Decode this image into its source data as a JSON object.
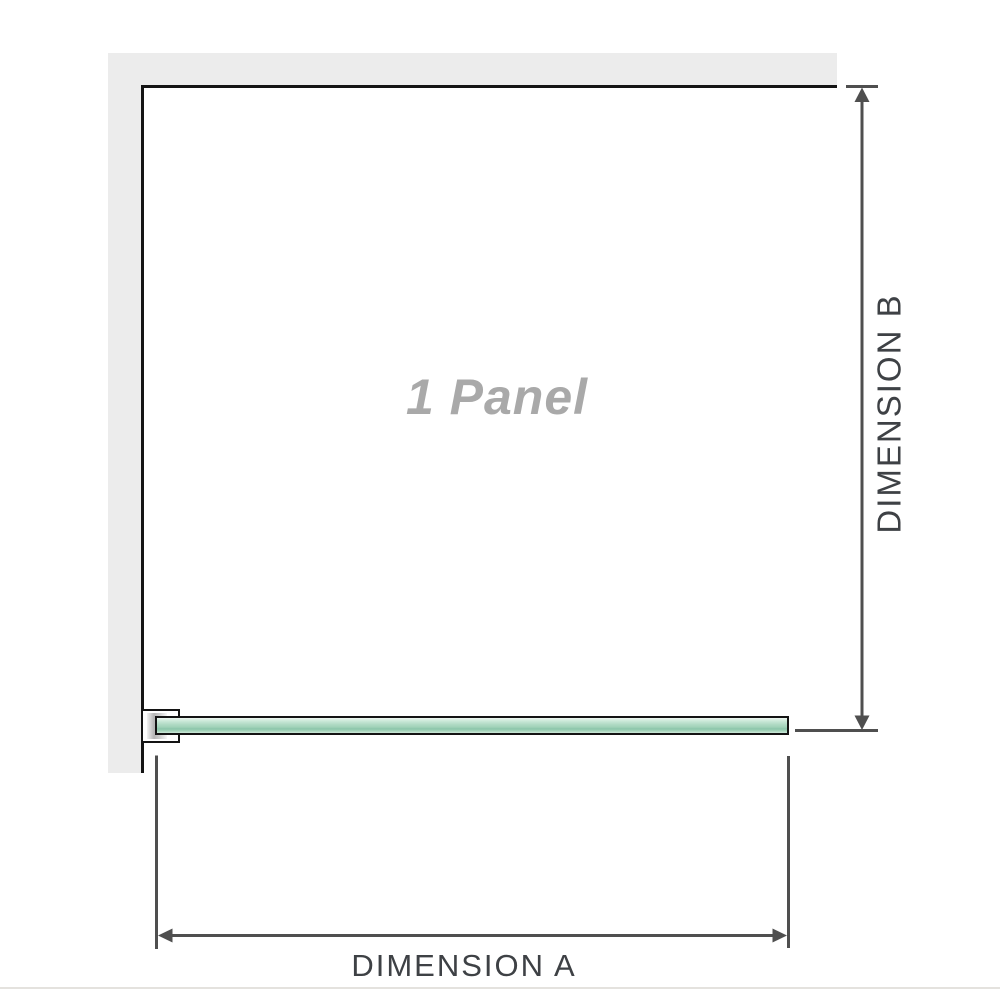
{
  "diagram": {
    "panel_label": "1 Panel",
    "dimension_a": {
      "label": "DIMENSION A"
    },
    "dimension_b": {
      "label": "DIMENSION B"
    }
  },
  "colors": {
    "wall_fill": "#ececec",
    "outline": "#141414",
    "dimension_line": "#4f4f4f",
    "dimension_text": "#3e4145",
    "panel_label_text": "#a9a9a9",
    "glass_green_light": "#cdeada",
    "glass_green_mid": "#a2d2b9",
    "glass_green_dark": "#8cc6ab",
    "bracket_metal": "#b5b5b5",
    "bottom_rule": "#e4e2de"
  }
}
